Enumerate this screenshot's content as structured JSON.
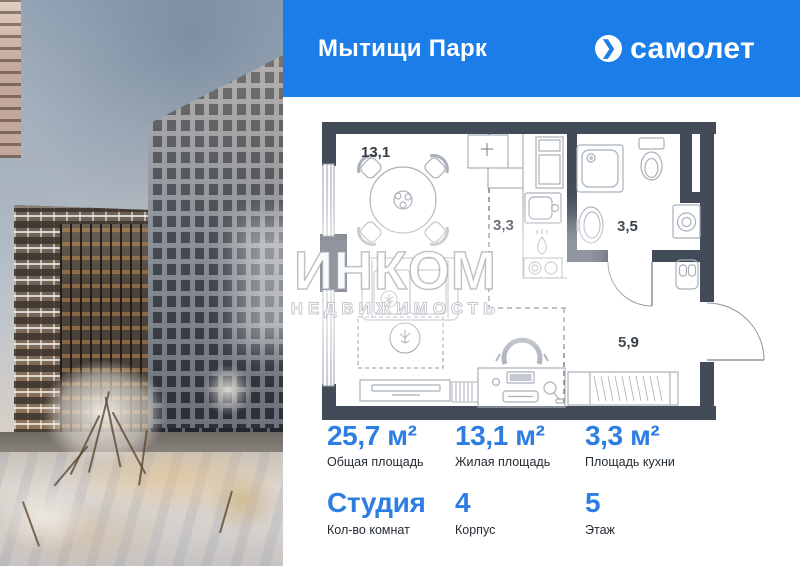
{
  "header": {
    "project_name": "Мытищи Парк",
    "brand_name": "самолет",
    "brand_icon": "chevron-right-in-circle"
  },
  "watermark": {
    "title": "ИНКОМ",
    "subtitle": "НЕДВИЖИМОСТЬ"
  },
  "plan": {
    "rooms": [
      {
        "name": "living-room",
        "area": "13,1"
      },
      {
        "name": "kitchen",
        "area": "3,3"
      },
      {
        "name": "bathroom",
        "area": "3,5"
      },
      {
        "name": "hallway",
        "area": "5,9"
      }
    ]
  },
  "stats": {
    "row1": [
      {
        "value": "25,7 м²",
        "label": "Общая площадь"
      },
      {
        "value": "13,1 м²",
        "label": "Жилая площадь"
      },
      {
        "value": "3,3 м²",
        "label": "Площадь кухни"
      }
    ],
    "row2": [
      {
        "value": "Студия",
        "label": "Кол-во комнат"
      },
      {
        "value": "4",
        "label": "Корпус"
      },
      {
        "value": "5",
        "label": "Этаж"
      }
    ]
  },
  "colors": {
    "header_blue": "#1b7de8",
    "accent_blue": "#2e7de2",
    "wall": "#434b59"
  }
}
